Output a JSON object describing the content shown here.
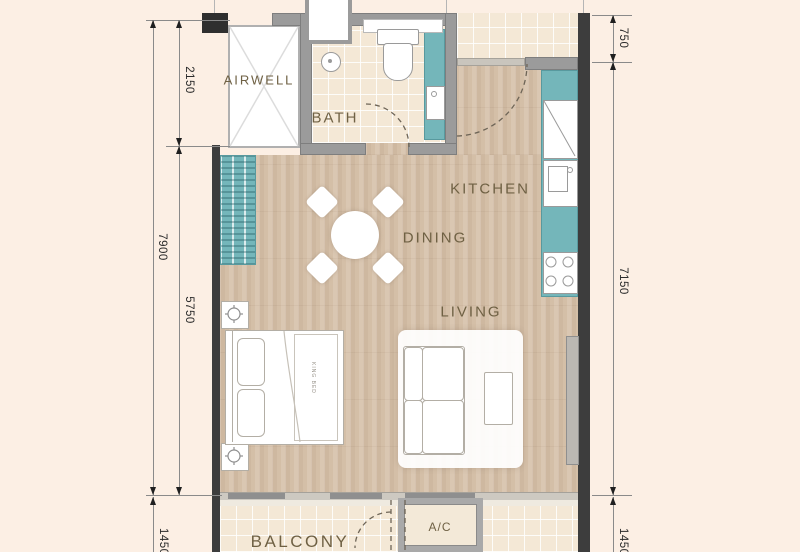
{
  "floorplan": {
    "rooms": {
      "airwell": "AIRWELL",
      "bath": "BATH",
      "kitchen": "KITCHEN",
      "dining": "DINING",
      "living": "LIVING",
      "balcony": "BALCONY",
      "ac": "A/C",
      "bed": "KING BED"
    },
    "dimensions_mm": {
      "left_total": "7900",
      "left_airwell": "2150",
      "left_main": "5750",
      "left_balcony": "1450",
      "right_corridor": "750",
      "right_main": "7150",
      "right_balcony": "1450"
    },
    "colors": {
      "background": "#fcefe4",
      "floor_wood": "#d7c2ab",
      "floor_tile": "#f4e8d6",
      "cabinet_teal": "#74b6ba",
      "wall_gray": "#9b9b9b",
      "wall_dark": "#3d3d3d",
      "label_text": "#6f6144"
    }
  }
}
